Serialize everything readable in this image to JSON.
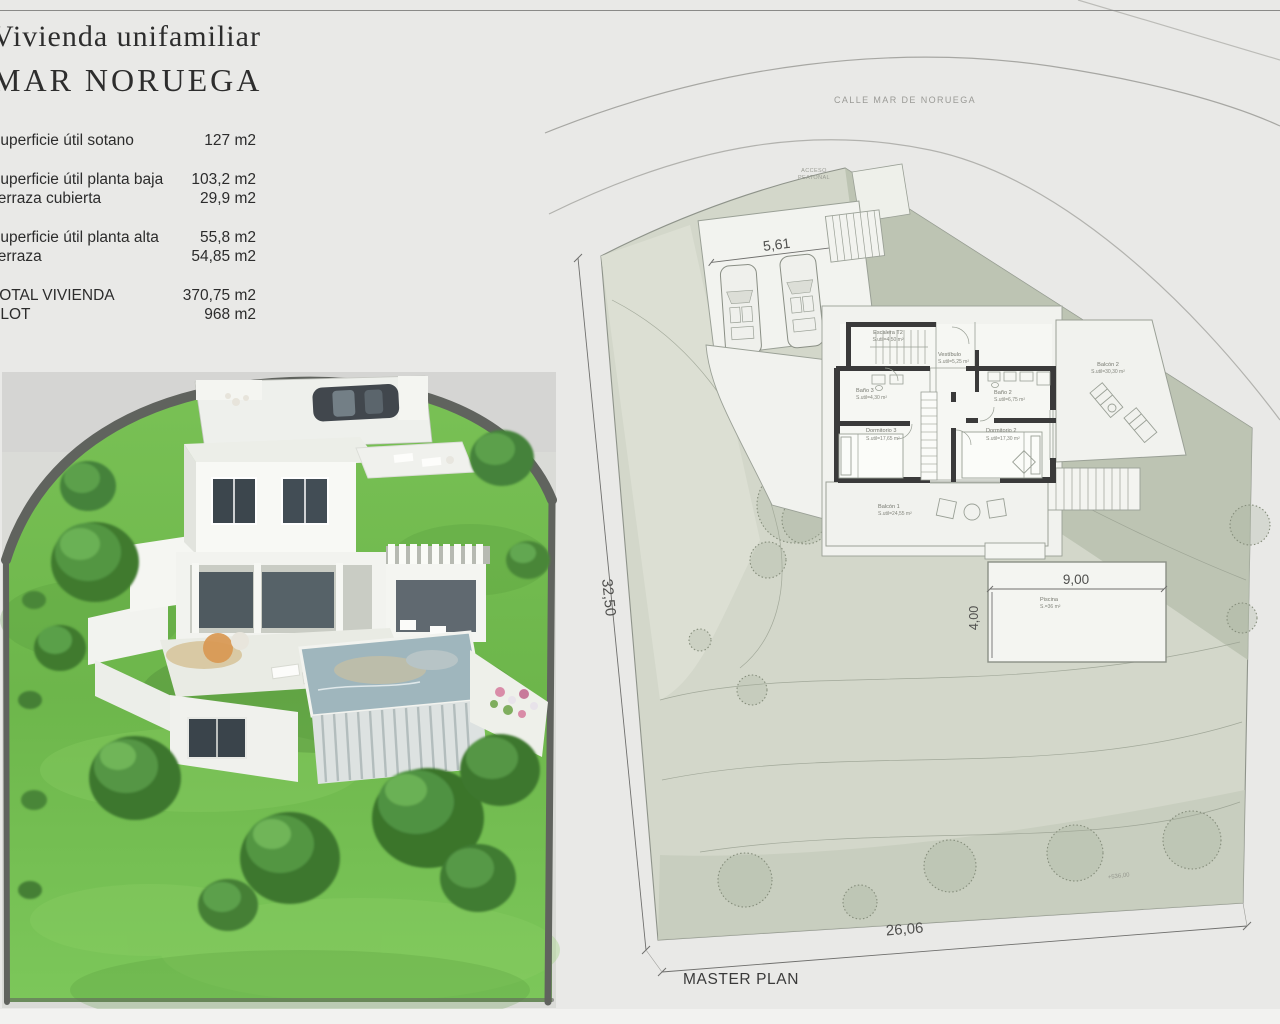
{
  "header": {
    "title_line1": "Vivienda unifamiliar",
    "title_line2": "MAR NORUEGA"
  },
  "area_table": {
    "rows": [
      {
        "label": "Superficie útil sotano",
        "value": "127 m2"
      },
      {
        "label": "Superficie útil planta baja",
        "value": "103,2 m2"
      },
      {
        "label": "Terraza cubierta",
        "value": "29,9 m2"
      },
      {
        "label": "Superficie útil planta alta",
        "value": "55,8 m2"
      },
      {
        "label": "Terraza",
        "value": "54,85 m2"
      },
      {
        "label": "TOTAL   VIVIENDA",
        "value": "370,75 m2"
      },
      {
        "label": "PLOT",
        "value": "968 m2"
      }
    ]
  },
  "site_plan": {
    "street_label": "CALLE MAR DE NORUEGA",
    "access_label_line1": "ACCESO",
    "access_label_line2": "PEATONAL",
    "contour_label": "+536,00",
    "caption": "MASTER PLAN",
    "dimensions": {
      "garage_width": "5,61",
      "plot_left_side": "32,50",
      "plot_bottom_side": "26,06",
      "pool_width": "9,00",
      "pool_height": "4,00"
    },
    "rooms": [
      {
        "name": "Escalera T2",
        "area": "S.util=4,50 m²"
      },
      {
        "name": "Vestíbulo",
        "area": "S.util=5,25 m²"
      },
      {
        "name": "Baño 3",
        "area": "S.util=4,30 m²"
      },
      {
        "name": "Baño 2",
        "area": "S.util=6,75 m²"
      },
      {
        "name": "Dormitorio 3",
        "area": "S.util=17,65 m²"
      },
      {
        "name": "Dormitorio 2",
        "area": "S.util=17,30 m²"
      },
      {
        "name": "Balcón 2",
        "area": "S.util=30,30 m²"
      },
      {
        "name": "Balcón 1",
        "area": "S.util=24,55 m²"
      },
      {
        "name": "Piscina",
        "area": "S.=36 m²"
      }
    ]
  },
  "colors": {
    "page_background": "#e9e9e7",
    "terrain_sage": "#d3d7ca",
    "terrain_dark_sage": "#b9c1af",
    "plan_line": "#8e938a",
    "wall_dark": "#3a3a3a",
    "lawn_green": "#6fbd4f",
    "perimeter_wall_gray": "#60635e",
    "text_dark": "#3a3a3a"
  }
}
